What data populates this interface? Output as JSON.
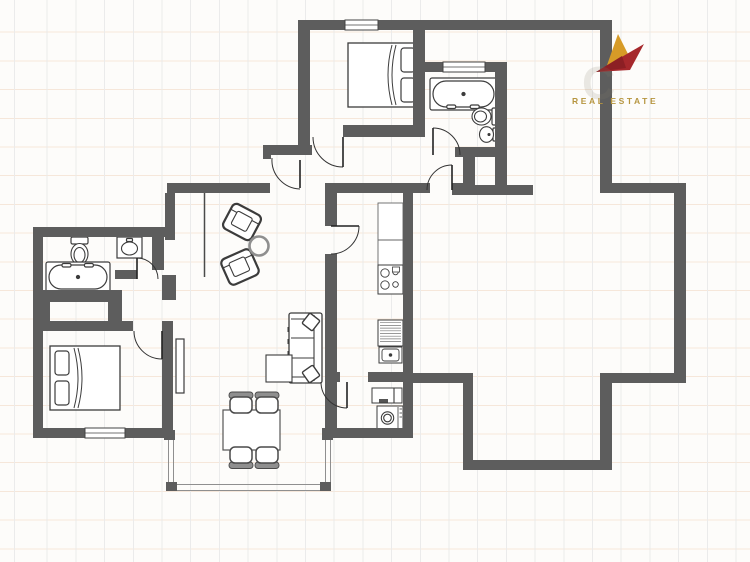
{
  "logo": {
    "watermark_letter": "C",
    "brand_line": "REAL ESTATE",
    "accent_gold": "#d79b27",
    "accent_red": "#a6282c",
    "accent_red_dark": "#8c1f24",
    "text_gold": "#b6953f"
  },
  "floorplan": {
    "colors": {
      "wall": "#5d5d5d",
      "furniture_line": "#3c3c3c",
      "light_line": "#8f8f8f",
      "chair_back": "#8f8f8f",
      "window_line": "#444444"
    },
    "walls": [
      [
        298,
        20,
        314,
        10
      ],
      [
        298,
        30,
        12,
        123
      ],
      [
        263,
        145,
        49,
        10
      ],
      [
        263,
        145,
        8,
        14
      ],
      [
        413,
        30,
        12,
        107
      ],
      [
        343,
        125,
        80,
        12
      ],
      [
        420,
        62,
        87,
        10
      ],
      [
        495,
        72,
        12,
        123
      ],
      [
        455,
        147,
        52,
        10
      ],
      [
        463,
        157,
        12,
        28
      ],
      [
        455,
        185,
        78,
        10
      ],
      [
        600,
        20,
        12,
        172
      ],
      [
        600,
        183,
        86,
        10
      ],
      [
        674,
        183,
        12,
        200
      ],
      [
        612,
        373,
        62,
        10
      ],
      [
        600,
        373,
        12,
        97
      ],
      [
        463,
        460,
        149,
        10
      ],
      [
        463,
        383,
        10,
        77
      ],
      [
        403,
        373,
        70,
        10
      ],
      [
        325,
        183,
        105,
        10
      ],
      [
        452,
        183,
        11,
        12
      ],
      [
        167,
        183,
        103,
        10
      ],
      [
        165,
        193,
        10,
        47
      ],
      [
        162,
        275,
        14,
        25
      ],
      [
        33,
        227,
        132,
        10
      ],
      [
        33,
        237,
        10,
        201
      ],
      [
        152,
        237,
        12,
        33
      ],
      [
        115,
        270,
        22,
        9
      ],
      [
        33,
        290,
        89,
        12
      ],
      [
        33,
        302,
        17,
        19
      ],
      [
        108,
        300,
        14,
        21
      ],
      [
        33,
        321,
        100,
        10
      ],
      [
        162,
        321,
        11,
        117
      ],
      [
        33,
        428,
        139,
        10
      ],
      [
        322,
        428,
        91,
        10
      ],
      [
        403,
        193,
        10,
        235
      ],
      [
        325,
        193,
        12,
        33
      ],
      [
        325,
        254,
        12,
        118
      ],
      [
        325,
        372,
        15,
        10
      ],
      [
        368,
        372,
        35,
        10
      ],
      [
        325,
        382,
        12,
        46
      ]
    ],
    "windows": [
      [
        345,
        20,
        33,
        10
      ],
      [
        443,
        62,
        42,
        10
      ],
      [
        85,
        428,
        40,
        10
      ]
    ],
    "doors": [
      {
        "leaf": [
          343,
          137,
          343,
          167
        ],
        "arc": "M313,137 A30,30 0 0 0 343,167"
      },
      {
        "leaf": [
          300,
          160,
          300,
          188
        ],
        "arc": "M272,158 A29,29 0 0 0 300,189"
      },
      {
        "leaf": [
          433,
          128,
          433,
          155
        ],
        "arc": "M433,128 A27,27 0 0 1 460,155"
      },
      {
        "leaf": [
          452,
          165,
          452,
          190
        ],
        "arc": "M452,165 A25,25 0 0 0 427,190"
      },
      {
        "leaf": [
          331,
          226,
          359,
          226
        ],
        "arc": "M359,226 A28,28 0 0 1 331,254"
      },
      {
        "leaf": [
          347,
          382,
          347,
          408
        ],
        "arc": "M347,408 A26,26 0 0 1 321,382"
      },
      {
        "leaf": [
          137,
          258,
          137,
          279
        ],
        "arc": "M137,258 A21,21 0 0 1 158,279"
      },
      {
        "leaf": [
          162,
          331,
          162,
          359
        ],
        "arc": "M162,359 A28,28 0 0 1 134,331"
      }
    ],
    "partitions": [
      [
        204.5,
        193,
        204.5,
        277
      ]
    ],
    "terrace": {
      "lines": [
        [
          168.5,
          438,
          168.5,
          490
        ],
        [
          173.5,
          438,
          173.5,
          490
        ],
        [
          325.5,
          438,
          325.5,
          490
        ],
        [
          330.5,
          438,
          330.5,
          490
        ],
        [
          168.5,
          484.5,
          330.5,
          484.5
        ],
        [
          168.5,
          490.5,
          330.5,
          490.5
        ]
      ],
      "posts": [
        [
          164,
          430,
          11,
          10
        ],
        [
          322,
          430,
          11,
          10
        ],
        [
          166,
          482,
          11,
          9
        ],
        [
          320,
          482,
          11,
          9
        ]
      ]
    },
    "furniture": [
      {
        "type": "double-bed",
        "x": 348,
        "y": 43,
        "w": 72,
        "h": 64,
        "pillows": "right"
      },
      {
        "type": "bathtub",
        "x": 430,
        "y": 78,
        "w": 67,
        "h": 32,
        "taps": "bottom"
      },
      {
        "type": "toilet",
        "x": 472,
        "y": 108,
        "facing": "left"
      },
      {
        "type": "wall-sink",
        "x": 480,
        "y": 126
      },
      {
        "type": "toilet",
        "x": 71,
        "y": 237,
        "facing": "down"
      },
      {
        "type": "vanity-sink",
        "x": 117,
        "y": 237,
        "w": 25,
        "h": 21
      },
      {
        "type": "bathtub",
        "x": 46,
        "y": 262,
        "w": 64,
        "h": 30,
        "taps": "top"
      },
      {
        "type": "double-bed",
        "x": 50,
        "y": 346,
        "w": 70,
        "h": 64,
        "pillows": "left"
      },
      {
        "type": "tv-board",
        "x": 176,
        "y": 339,
        "w": 8,
        "h": 54
      },
      {
        "type": "armchair",
        "cx": 242,
        "cy": 222,
        "rot": 28
      },
      {
        "type": "armchair",
        "cx": 240,
        "cy": 267,
        "rot": -24
      },
      {
        "type": "side-table",
        "cx": 259,
        "cy": 246,
        "r": 9.5
      },
      {
        "type": "sofa",
        "x": 289,
        "y": 313,
        "w": 33,
        "h": 70
      },
      {
        "type": "coffee-table",
        "x": 266,
        "y": 355,
        "w": 26,
        "h": 27
      },
      {
        "type": "dining-table",
        "x": 223,
        "y": 410,
        "w": 57,
        "h": 40
      },
      {
        "type": "dining-chair",
        "cx": 241,
        "cy": 405,
        "back": "up"
      },
      {
        "type": "dining-chair",
        "cx": 267,
        "cy": 405,
        "back": "up"
      },
      {
        "type": "dining-chair",
        "cx": 241,
        "cy": 455,
        "back": "down"
      },
      {
        "type": "dining-chair",
        "cx": 267,
        "cy": 455,
        "back": "down"
      },
      {
        "type": "upper-cabinet",
        "x": 378,
        "y": 203,
        "w": 25,
        "h": 62
      },
      {
        "type": "stove",
        "x": 378,
        "y": 265,
        "w": 25,
        "h": 29
      },
      {
        "type": "kitchen-sink",
        "x": 378,
        "y": 320,
        "w": 25,
        "h": 43
      },
      {
        "type": "laundry-cabinet",
        "x": 372,
        "y": 388,
        "w": 30,
        "h": 15
      },
      {
        "type": "washing-machine",
        "x": 377,
        "y": 406,
        "w": 26,
        "h": 24
      }
    ]
  }
}
